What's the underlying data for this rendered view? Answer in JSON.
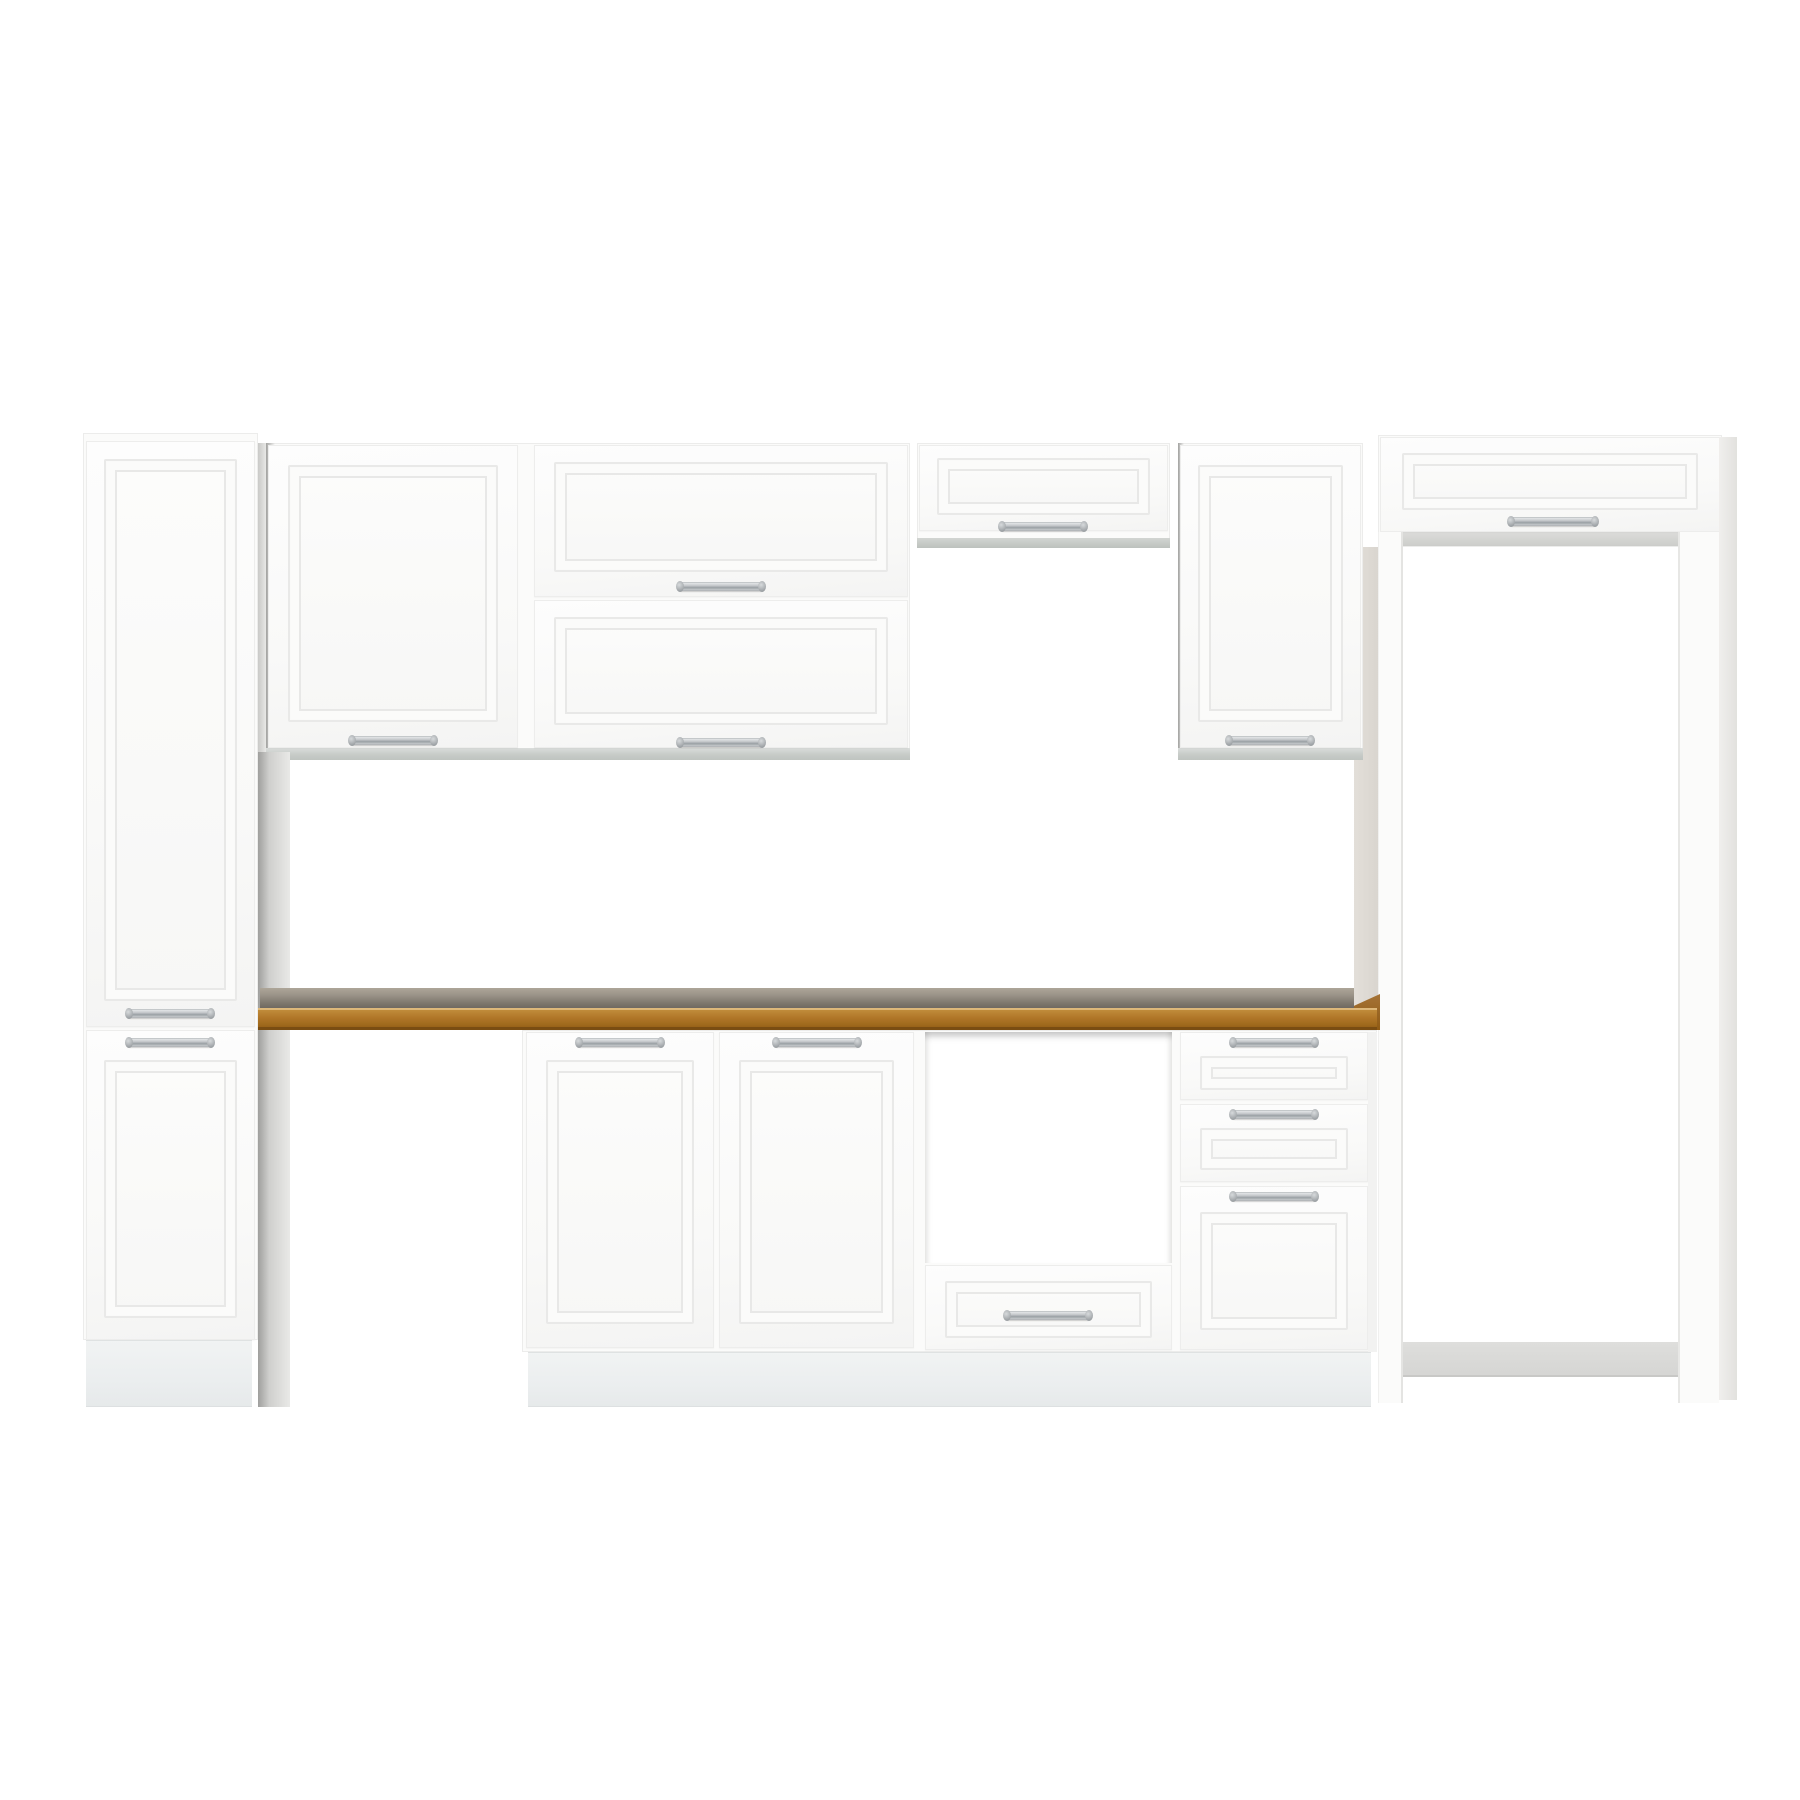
{
  "scene": {
    "type": "product-photo",
    "subject": "white modular kitchen cabinet set with raised-panel doors, chrome bar handles and oak-colored countertop",
    "background": "#ffffff",
    "text_content": "none"
  },
  "colors": {
    "bg": "#ffffff",
    "cabinet_white": "#fbfbfa",
    "door_face": "#fdfdfd",
    "panel_line": "#e9e9e8",
    "underside_grey": "#c7cbc8",
    "plinth_grey": "#ebeeef",
    "handle_light": "#eef0f1",
    "handle_mid": "#9aa0a4",
    "counter_top_light": "#9c958a",
    "counter_top_dark": "#69635b",
    "wood_light": "#c4913f",
    "wood_mid": "#b07628",
    "wood_dark": "#8f5a13",
    "surround_inner": "#d9d5cf",
    "back_panel": "#d5d5d3"
  },
  "units": [
    {
      "name": "tall-pantry-cabinet",
      "kind": "tall cabinet, 2 doors",
      "doors": 2,
      "handles": 2
    },
    {
      "name": "wall-cabinet-left",
      "kind": "wall cabinet, 1 door",
      "doors": 1,
      "handles": 1
    },
    {
      "name": "bridge-wall-cabinet",
      "kind": "wide wall cabinet, 2 horizontal flip doors",
      "doors": 2,
      "handles": 2
    },
    {
      "name": "hood-wall-cabinet",
      "kind": "short wall cabinet over cooker area",
      "doors": 1,
      "handles": 1
    },
    {
      "name": "wall-cabinet-right",
      "kind": "wall cabinet, 1 door",
      "doors": 1,
      "handles": 1
    },
    {
      "name": "fridge-surround",
      "kind": "tall appliance surround with top flip cabinet and open bay",
      "doors": 1,
      "handles": 1,
      "opening": true
    },
    {
      "name": "countertop",
      "kind": "oak-colored worktop"
    },
    {
      "name": "base-cabinet-two-door",
      "kind": "base cabinet, 2 doors",
      "doors": 2,
      "handles": 2
    },
    {
      "name": "oven-base-opening",
      "kind": "appliance opening with drawer below",
      "drawers": 1,
      "handles": 1
    },
    {
      "name": "base-drawer-unit",
      "kind": "base unit with 3 drawers",
      "drawers": 3,
      "handles": 3
    }
  ]
}
